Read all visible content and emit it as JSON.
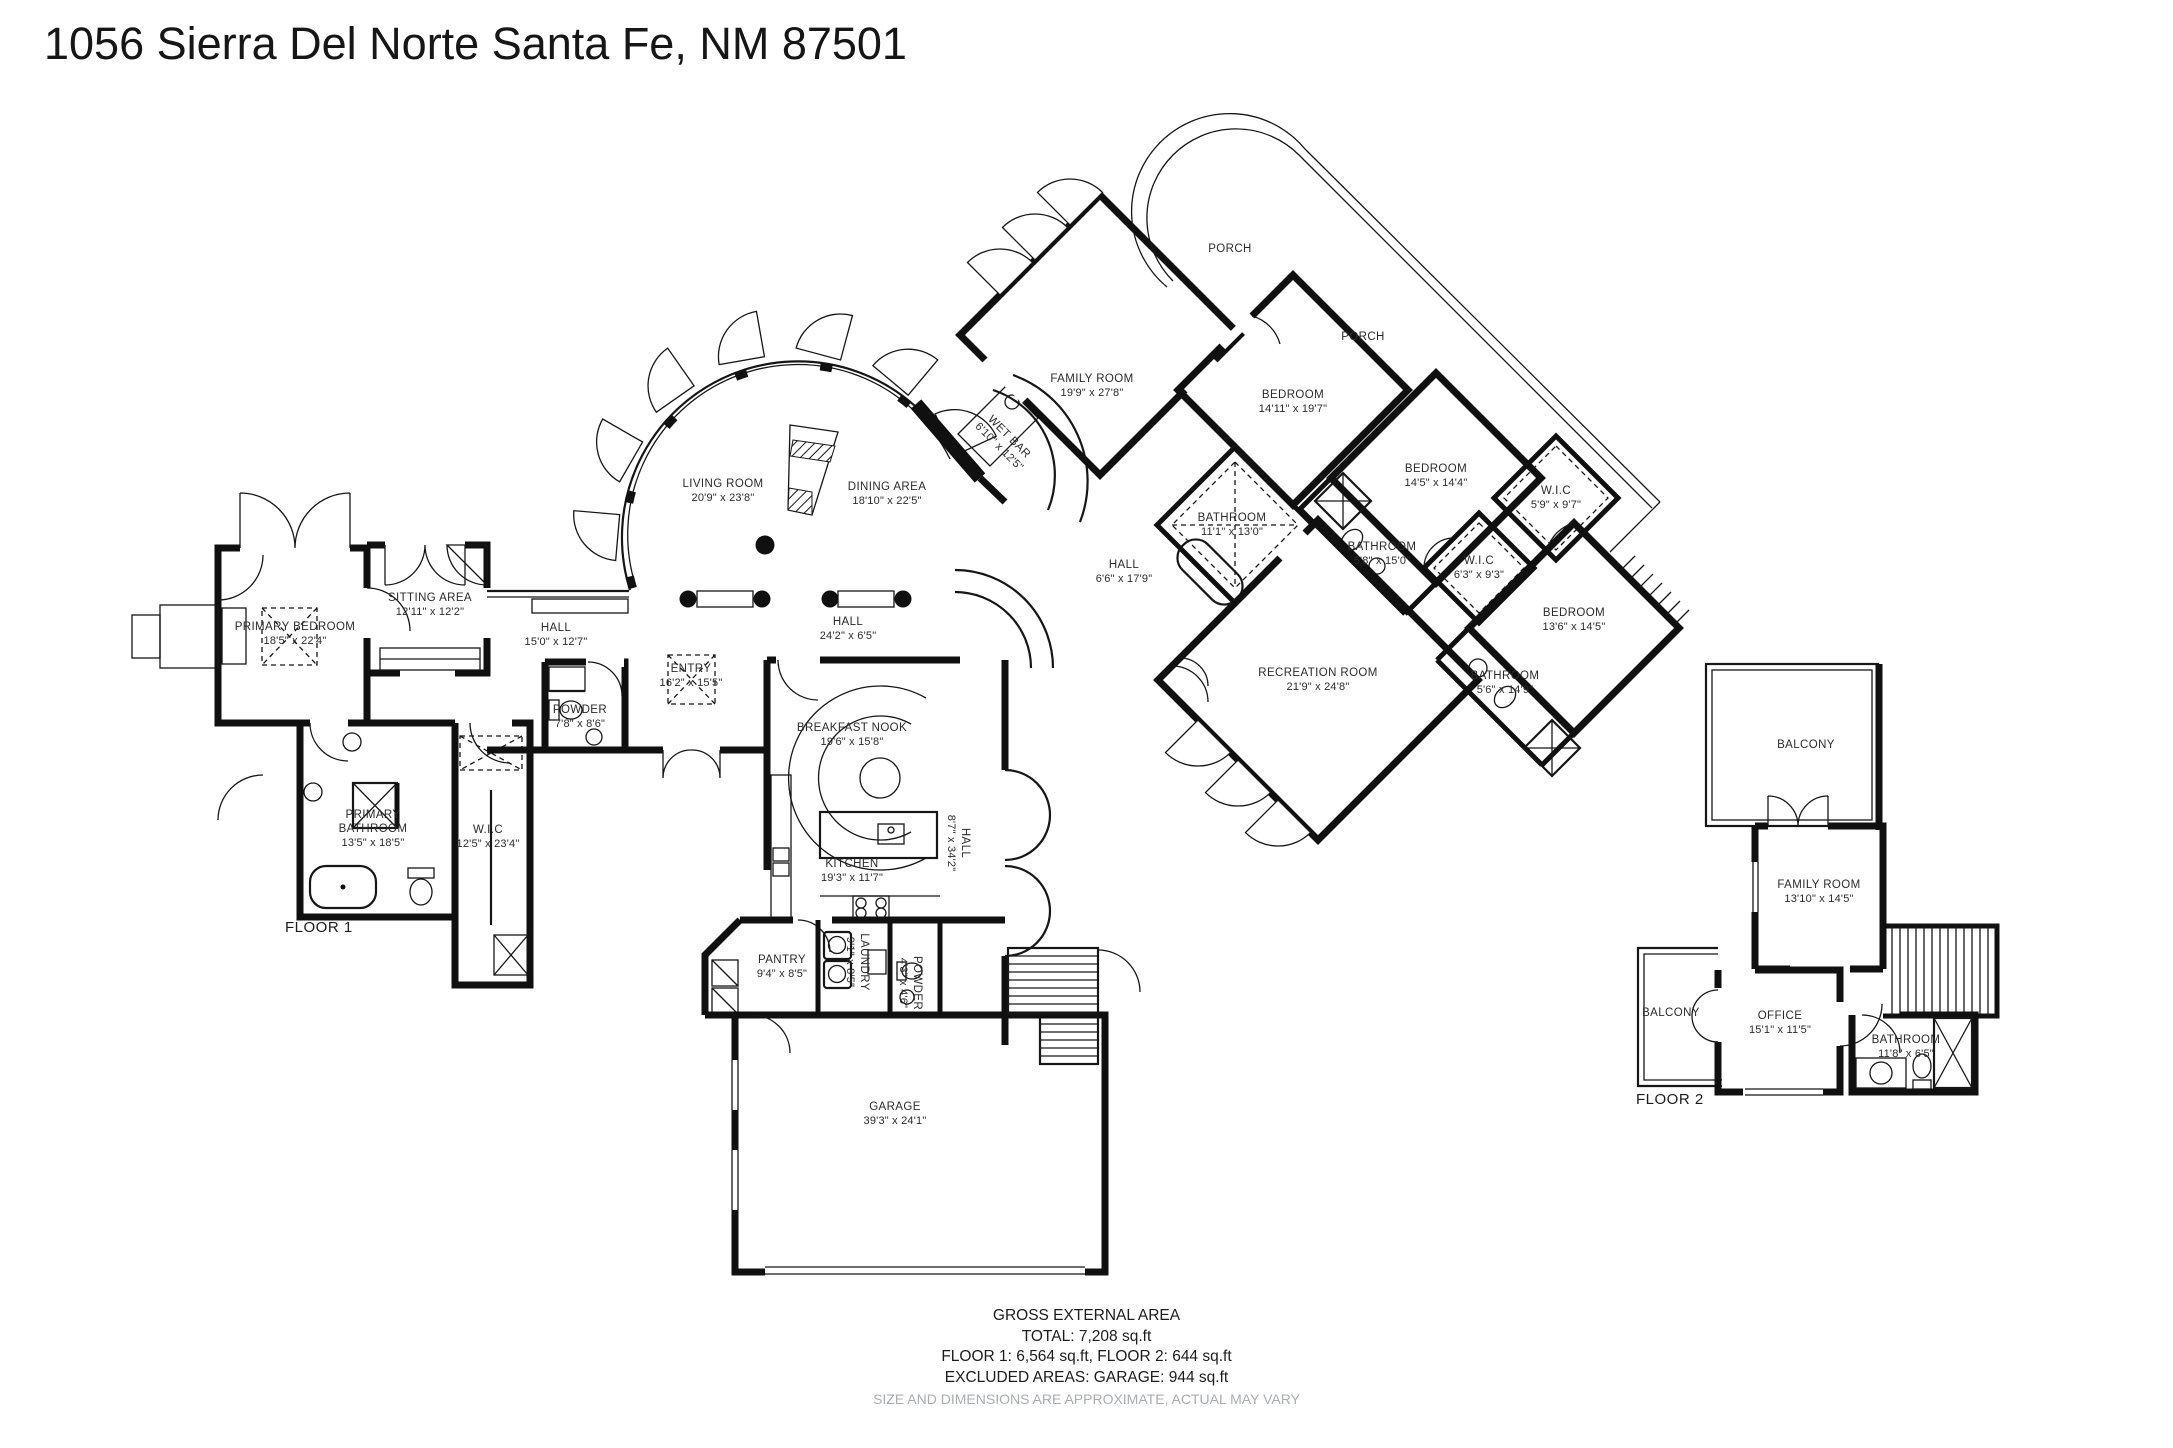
{
  "title": "1056 Sierra Del Norte Santa Fe, NM 87501",
  "floor1": {
    "label": "FLOOR 1"
  },
  "floor2": {
    "label": "FLOOR 2"
  },
  "rooms": {
    "primary_bedroom": {
      "name": "PRIMARY BEDROOM",
      "dims": "18'5\" x 22'4\""
    },
    "sitting_area": {
      "name": "SITTING AREA",
      "dims": "12'11\" x 12'2\""
    },
    "primary_bathroom": {
      "line1": "PRIMARY",
      "line2": "BATHROOM",
      "dims": "13'5\" x 18'5\""
    },
    "wic_primary": {
      "name": "W.I.C",
      "dims": "12'5\" x 23'4\""
    },
    "hall_west": {
      "name": "HALL",
      "dims": "15'0\" x 12'7\""
    },
    "powder_main": {
      "name": "POWDER",
      "dims": "7'8\" x 8'6\""
    },
    "entry": {
      "name": "ENTRY",
      "dims": "16'2\" x 15'5\""
    },
    "living_room": {
      "name": "LIVING ROOM",
      "dims": "20'9\" x 23'8\""
    },
    "dining_area": {
      "name": "DINING AREA",
      "dims": "18'10\" x 22'5\""
    },
    "wet_bar": {
      "name": "WET BAR",
      "dims": "6'10\" x 12'5\""
    },
    "hall_center": {
      "name": "HALL",
      "dims": "24'2\" x 6'5\""
    },
    "family_room": {
      "name": "FAMILY ROOM",
      "dims": "19'9\" x 27'8\""
    },
    "porch": {
      "name": "PORCH"
    },
    "bedroom_ne": {
      "name": "BEDROOM",
      "dims": "14'11\" x 19'7\""
    },
    "hall_bedrooms": {
      "name": "HALL",
      "dims": "6'6\" x 17'9\""
    },
    "bathroom_main": {
      "name": "BATHROOM",
      "dims": "11'1\" x 13'0\""
    },
    "bathroom_2": {
      "name": "BATHROOM",
      "dims": "5'8\" x 15'0\""
    },
    "bedroom_e": {
      "name": "BEDROOM",
      "dims": "14'5\" x 14'4\""
    },
    "wic_2": {
      "name": "W.I.C",
      "dims": "5'9\" x 9'7\""
    },
    "wic_3": {
      "name": "W.I.C",
      "dims": "6'3\" x 9'3\""
    },
    "bedroom_se": {
      "name": "BEDROOM",
      "dims": "13'6\" x 14'5\""
    },
    "bathroom_3": {
      "name": "BATHROOM",
      "dims": "5'6\" x 14'9\""
    },
    "recreation_room": {
      "name": "RECREATION ROOM",
      "dims": "21'9\" x 24'8\""
    },
    "breakfast_nook": {
      "name": "BREAKFAST NOOK",
      "dims": "19'6\" x 15'8\""
    },
    "kitchen": {
      "name": "KITCHEN",
      "dims": "19'3\" x 11'7\""
    },
    "hall_south": {
      "name": "HALL",
      "dims": "8'7\" x 34'2\""
    },
    "pantry": {
      "name": "PANTRY",
      "dims": "9'4\" x 8'5\""
    },
    "laundry": {
      "name": "LAUNDRY",
      "dims": "9'1\" x 8'5\""
    },
    "powder_2": {
      "name": "POWDER",
      "dims": "4'3\" x 4'6\""
    },
    "garage": {
      "name": "GARAGE",
      "dims": "39'3\" x 24'1\""
    },
    "balcony": {
      "name": "BALCONY"
    },
    "family_room_2": {
      "name": "FAMILY ROOM",
      "dims": "13'10\" x 14'5\""
    },
    "office": {
      "name": "OFFICE",
      "dims": "15'1\" x 11'5\""
    },
    "bathroom_4": {
      "name": "BATHROOM",
      "dims": "11'8\" x 6'5\""
    }
  },
  "footer": {
    "heading": "GROSS EXTERNAL AREA",
    "total": "TOTAL: 7,208 sq.ft",
    "floors": "FLOOR 1: 6,564 sq.ft, FLOOR 2: 644 sq.ft",
    "excluded": "EXCLUDED AREAS: GARAGE: 944 sq.ft",
    "disclaimer": "SIZE AND DIMENSIONS ARE APPROXIMATE, ACTUAL MAY VARY"
  }
}
